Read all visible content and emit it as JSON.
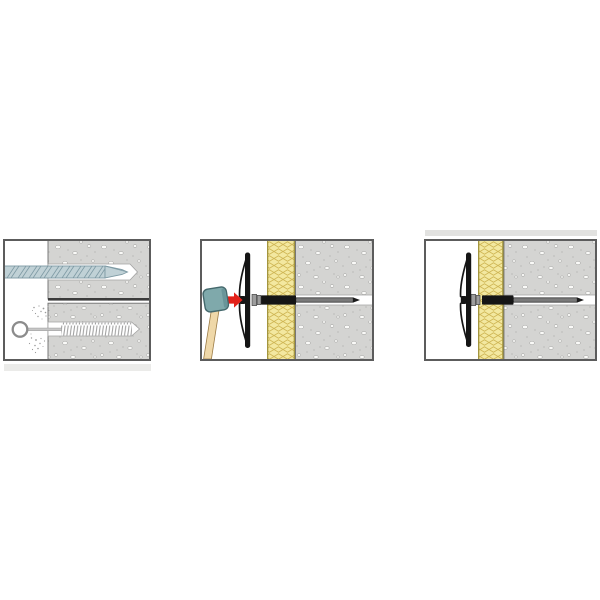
{
  "colors": {
    "canvas": "#ffffff",
    "panel-border": "#5c5c5c",
    "block-edge": "#6e6e6e",
    "divider": "#3c3c3c",
    "concrete": "#d4d4d2",
    "concrete-speckle": "#fafaf8",
    "concrete-speckle-outline": "#9e9e9c",
    "concrete-dot": "#bfbfbd",
    "insulation": "#f3e8a0",
    "insulation-line": "#cfb654",
    "insulation-edge": "#a3953e",
    "hole-outline": "#a2a2a2",
    "plastic-black": "#151515",
    "pin-gray": "#6a6a6a",
    "pin-edge": "#1c1c1c",
    "collar-gray": "#9d9d9d",
    "drill-fill": "#c0d1d6",
    "drill-outline": "#7e9aa4",
    "hammer-head": "#7fa9ab",
    "hammer-head-outline": "#44686c",
    "hammer-face": "#699599",
    "handle-light": "#efd8a9",
    "handle-dark": "#cba76b",
    "handle-outline": "#9b7b45",
    "arrow-red": "#e32119",
    "brush-gray": "#9b9b9b",
    "ring-gray": "#8c8c8c",
    "shaft-gray": "#c6c6c6",
    "artifact-strip-top": "#e2e2e0",
    "artifact-strip-bottom": "#ebebe9"
  },
  "panels": [
    {
      "name": "drill-and-clean-hole",
      "icons": [
        "drill-bit-icon",
        "drilled-hole",
        "cleaning-brush-icon",
        "dust-particles",
        "concrete-wall"
      ]
    },
    {
      "name": "hammer-in-insulation-fastener",
      "icons": [
        "hammer-icon",
        "direction-arrow-icon",
        "fastener-disc",
        "expansion-sleeve",
        "metal-pin",
        "insulation-layer",
        "concrete-wall",
        "drilled-hole"
      ]
    },
    {
      "name": "fastener-installed",
      "icons": [
        "fastener-disc",
        "expansion-sleeve",
        "metal-pin",
        "insulation-layer",
        "concrete-wall",
        "drilled-hole"
      ]
    }
  ]
}
